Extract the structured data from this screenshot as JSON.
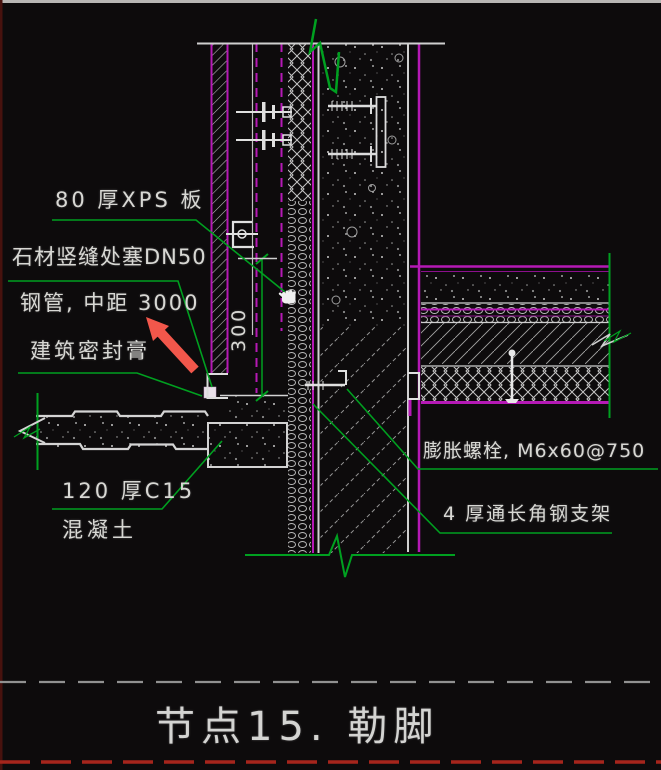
{
  "title": "节点15. 勒脚",
  "annotations": {
    "xps_board": "80 厚XPS 板",
    "stone_joint_line1": "石材竖缝处塞DN50",
    "stone_joint_line2": "钢管, 中距 3000",
    "sealant": "建筑密封膏",
    "plinth_line1": "120 厚C15",
    "plinth_line2": "混凝土",
    "expansion_bolt": "膨胀螺栓, M6x60@750",
    "angle_bracket": "4 厚通长角钢支架"
  },
  "dimensions": {
    "cavity_height": "300"
  },
  "colors": {
    "background": "#0d0b0c",
    "line_green": "#00a020",
    "line_magenta": "#b519b5",
    "line_white": "#d6d6d6",
    "dashed_gray": "#919191",
    "dashed_red": "#a6251c",
    "arrow_red": "#f2574b"
  },
  "icons": [
    {
      "name": "pan-hand-cursor"
    },
    {
      "name": "red-annotation-arrow"
    }
  ]
}
